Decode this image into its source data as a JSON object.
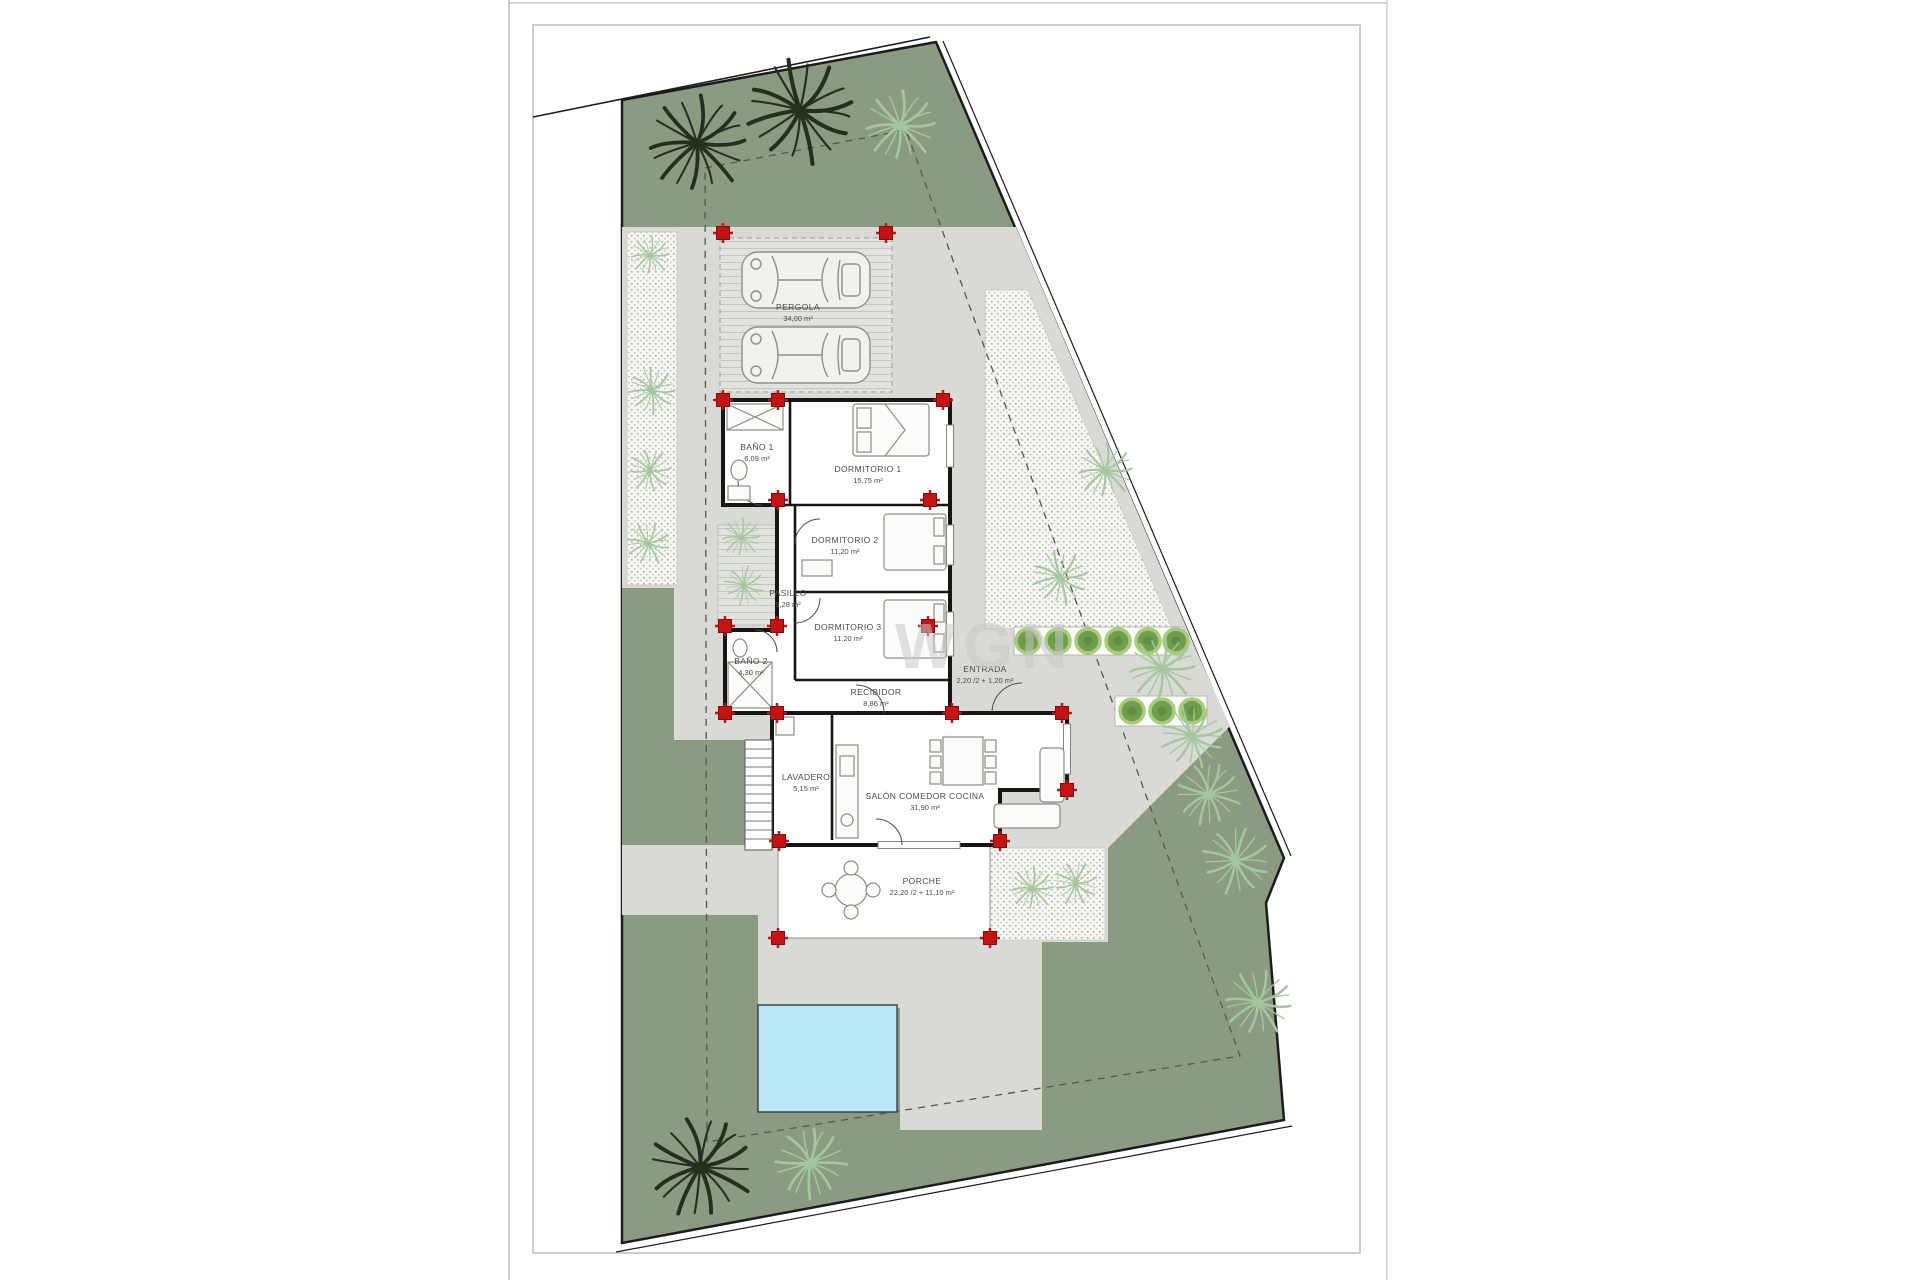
{
  "watermark": "WGN",
  "plan": {
    "type": "villa-floor-plan-site-plan",
    "rooms": [
      {
        "name": "PERGOLA",
        "area": "34,00 m²"
      },
      {
        "name": "BAÑO 1",
        "area": "6,09 m²"
      },
      {
        "name": "DORMITORIO 1",
        "area": "15,75 m²"
      },
      {
        "name": "DORMITORIO 2",
        "area": "11,20 m²"
      },
      {
        "name": "PASILLO",
        "area": "9,28 m²"
      },
      {
        "name": "DORMITORIO 3",
        "area": "11,20 m²"
      },
      {
        "name": "BAÑO 2",
        "area": "4,30 m²"
      },
      {
        "name": "RECIBIDOR",
        "area": "8,86 m²"
      },
      {
        "name": "ENTRADA",
        "area": "2,20 /2 + 1,20 m²"
      },
      {
        "name": "LAVADERO",
        "area": "5,15 m²"
      },
      {
        "name": "SALÓN COMEDOR COCINA",
        "area": "31,90 m²"
      },
      {
        "name": "PORCHE",
        "area": "22,20 /2 + 11,10 m²"
      }
    ],
    "colors": {
      "garden": "#8b9b81",
      "pavement": "#d9d9d6",
      "pool": "#b9e7f6",
      "column_marker": "#c21414",
      "wall": "#161616"
    }
  }
}
